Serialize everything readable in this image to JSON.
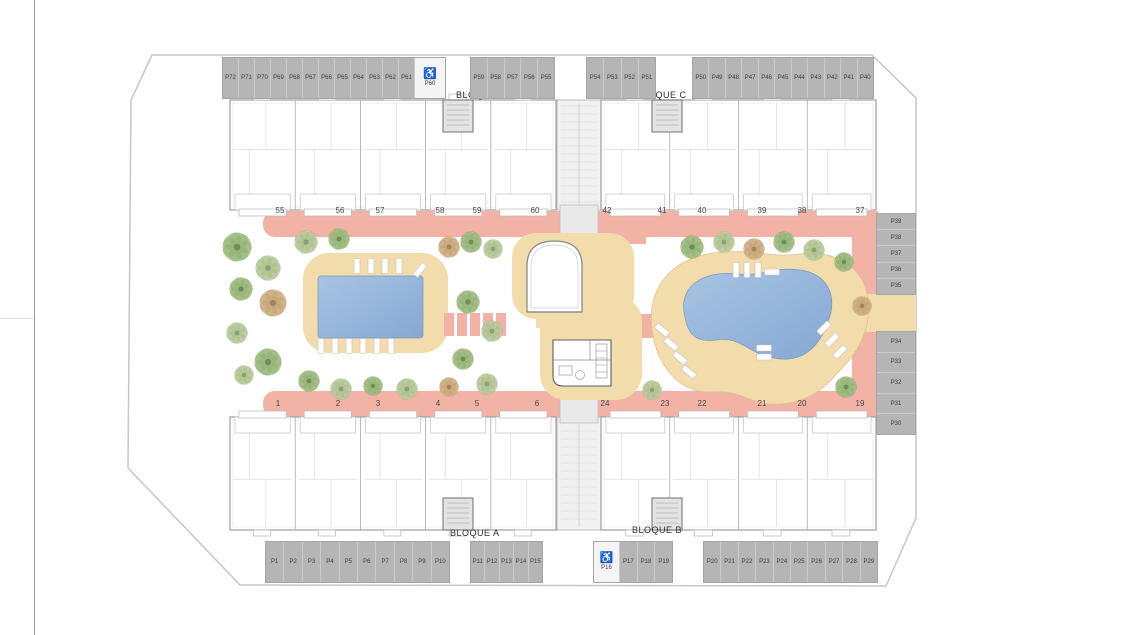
{
  "plan": {
    "blocks": {
      "a_label": "BLOQUE A",
      "b_label": "BLOQUE B",
      "c_label": "BLOQUE C",
      "d_label": "BLOQUE D"
    },
    "parking": {
      "accessible_icon": "♿",
      "top_left_row": [
        "P72",
        "P71",
        "P70",
        "P69",
        "P68",
        "P67",
        "P66",
        "P65",
        "P64",
        "P63",
        "P62",
        "P61"
      ],
      "top_left_accessible": "P60",
      "top_center_left_row": [
        "P59",
        "P58",
        "P57",
        "P56",
        "P55"
      ],
      "top_center_right_row": [
        "P54",
        "P53",
        "P52",
        "P51"
      ],
      "top_right_row": [
        "P50",
        "P49",
        "P48",
        "P47",
        "P46",
        "P45",
        "P44",
        "P43",
        "P42",
        "P41",
        "P40"
      ],
      "right_upper_column": [
        "P39",
        "P38",
        "P37",
        "P36",
        "P35"
      ],
      "right_lower_column": [
        "P34",
        "P33",
        "P32",
        "P31",
        "P30"
      ],
      "bottom_left_row": [
        "P1",
        "P2",
        "P3",
        "P4",
        "P5",
        "P6",
        "P7",
        "P8",
        "P9",
        "P10"
      ],
      "bottom_center_left_row": [
        "P11",
        "P12",
        "P13",
        "P14",
        "P15"
      ],
      "bottom_center_right_accessible": "P16",
      "bottom_center_right_row": [
        "P17",
        "P18",
        "P19"
      ],
      "bottom_right_row": [
        "P20",
        "P21",
        "P22",
        "P23",
        "P24",
        "P25",
        "P26",
        "P27",
        "P28",
        "P29"
      ]
    },
    "unit_numbers": {
      "top_row": [
        {
          "label": "55",
          "x": 280
        },
        {
          "label": "56",
          "x": 340
        },
        {
          "label": "57",
          "x": 380
        },
        {
          "label": "58",
          "x": 440
        },
        {
          "label": "59",
          "x": 477
        },
        {
          "label": "60",
          "x": 535
        },
        {
          "label": "42",
          "x": 607
        },
        {
          "label": "41",
          "x": 662
        },
        {
          "label": "40",
          "x": 702
        },
        {
          "label": "39",
          "x": 762
        },
        {
          "label": "38",
          "x": 802
        },
        {
          "label": "37",
          "x": 860
        }
      ],
      "bottom_row": [
        {
          "label": "1",
          "x": 278
        },
        {
          "label": "2",
          "x": 338
        },
        {
          "label": "3",
          "x": 378
        },
        {
          "label": "4",
          "x": 438
        },
        {
          "label": "5",
          "x": 477
        },
        {
          "label": "6",
          "x": 537
        },
        {
          "label": "24",
          "x": 605
        },
        {
          "label": "23",
          "x": 665
        },
        {
          "label": "22",
          "x": 702
        },
        {
          "label": "21",
          "x": 762
        },
        {
          "label": "20",
          "x": 802
        },
        {
          "label": "19",
          "x": 860
        }
      ]
    },
    "colors": {
      "walkway": "#f2b2a6",
      "deck": "#f3dcab",
      "pool_light": "#a9c4e3",
      "pool_dark": "#85a8d3",
      "parking": "#b5b5b5",
      "parking_accessible": "#f4f4f4",
      "entrance_marker": "#6fae5d",
      "boundary": "#c6c6c6"
    },
    "landscape": {
      "trees": [
        [
          237,
          247,
          15,
          0
        ],
        [
          268,
          268,
          13,
          1
        ],
        [
          241,
          289,
          12,
          0
        ],
        [
          273,
          303,
          14,
          2
        ],
        [
          237,
          333,
          11,
          1
        ],
        [
          268,
          362,
          14,
          0
        ],
        [
          244,
          375,
          10,
          1
        ],
        [
          306,
          242,
          12,
          1
        ],
        [
          339,
          239,
          11,
          0
        ],
        [
          449,
          247,
          11,
          2
        ],
        [
          471,
          242,
          11,
          0
        ],
        [
          493,
          249,
          10,
          1
        ],
        [
          468,
          302,
          12,
          0
        ],
        [
          492,
          331,
          11,
          1
        ],
        [
          463,
          359,
          11,
          0
        ],
        [
          487,
          384,
          11,
          1
        ],
        [
          309,
          381,
          11,
          0
        ],
        [
          341,
          389,
          11,
          1
        ],
        [
          373,
          386,
          10,
          0
        ],
        [
          407,
          389,
          11,
          1
        ],
        [
          449,
          387,
          10,
          2
        ],
        [
          692,
          247,
          12,
          0
        ],
        [
          724,
          242,
          11,
          1
        ],
        [
          754,
          249,
          11,
          2
        ],
        [
          784,
          242,
          11,
          0
        ],
        [
          814,
          250,
          11,
          1
        ],
        [
          844,
          262,
          10,
          0
        ],
        [
          862,
          306,
          10,
          2
        ],
        [
          846,
          387,
          11,
          0
        ],
        [
          652,
          390,
          10,
          1
        ]
      ]
    }
  }
}
